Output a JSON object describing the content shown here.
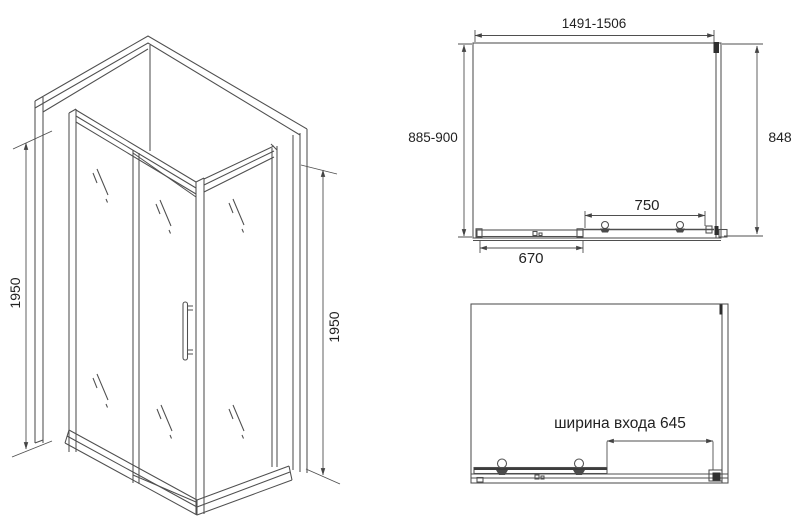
{
  "title": "Shower enclosure dimension drawing",
  "colors": {
    "background": "#ffffff",
    "line": "#4f4f4f",
    "text": "#222222"
  },
  "iso_view": {
    "height_left": "1950",
    "height_right": "1950"
  },
  "plan_view": {
    "width_range": "1491-1506",
    "depth_range": "885-900",
    "side_depth": "848",
    "panel_width": "750",
    "door_width": "670"
  },
  "open_view": {
    "entrance_label": "ширина входа 645"
  }
}
